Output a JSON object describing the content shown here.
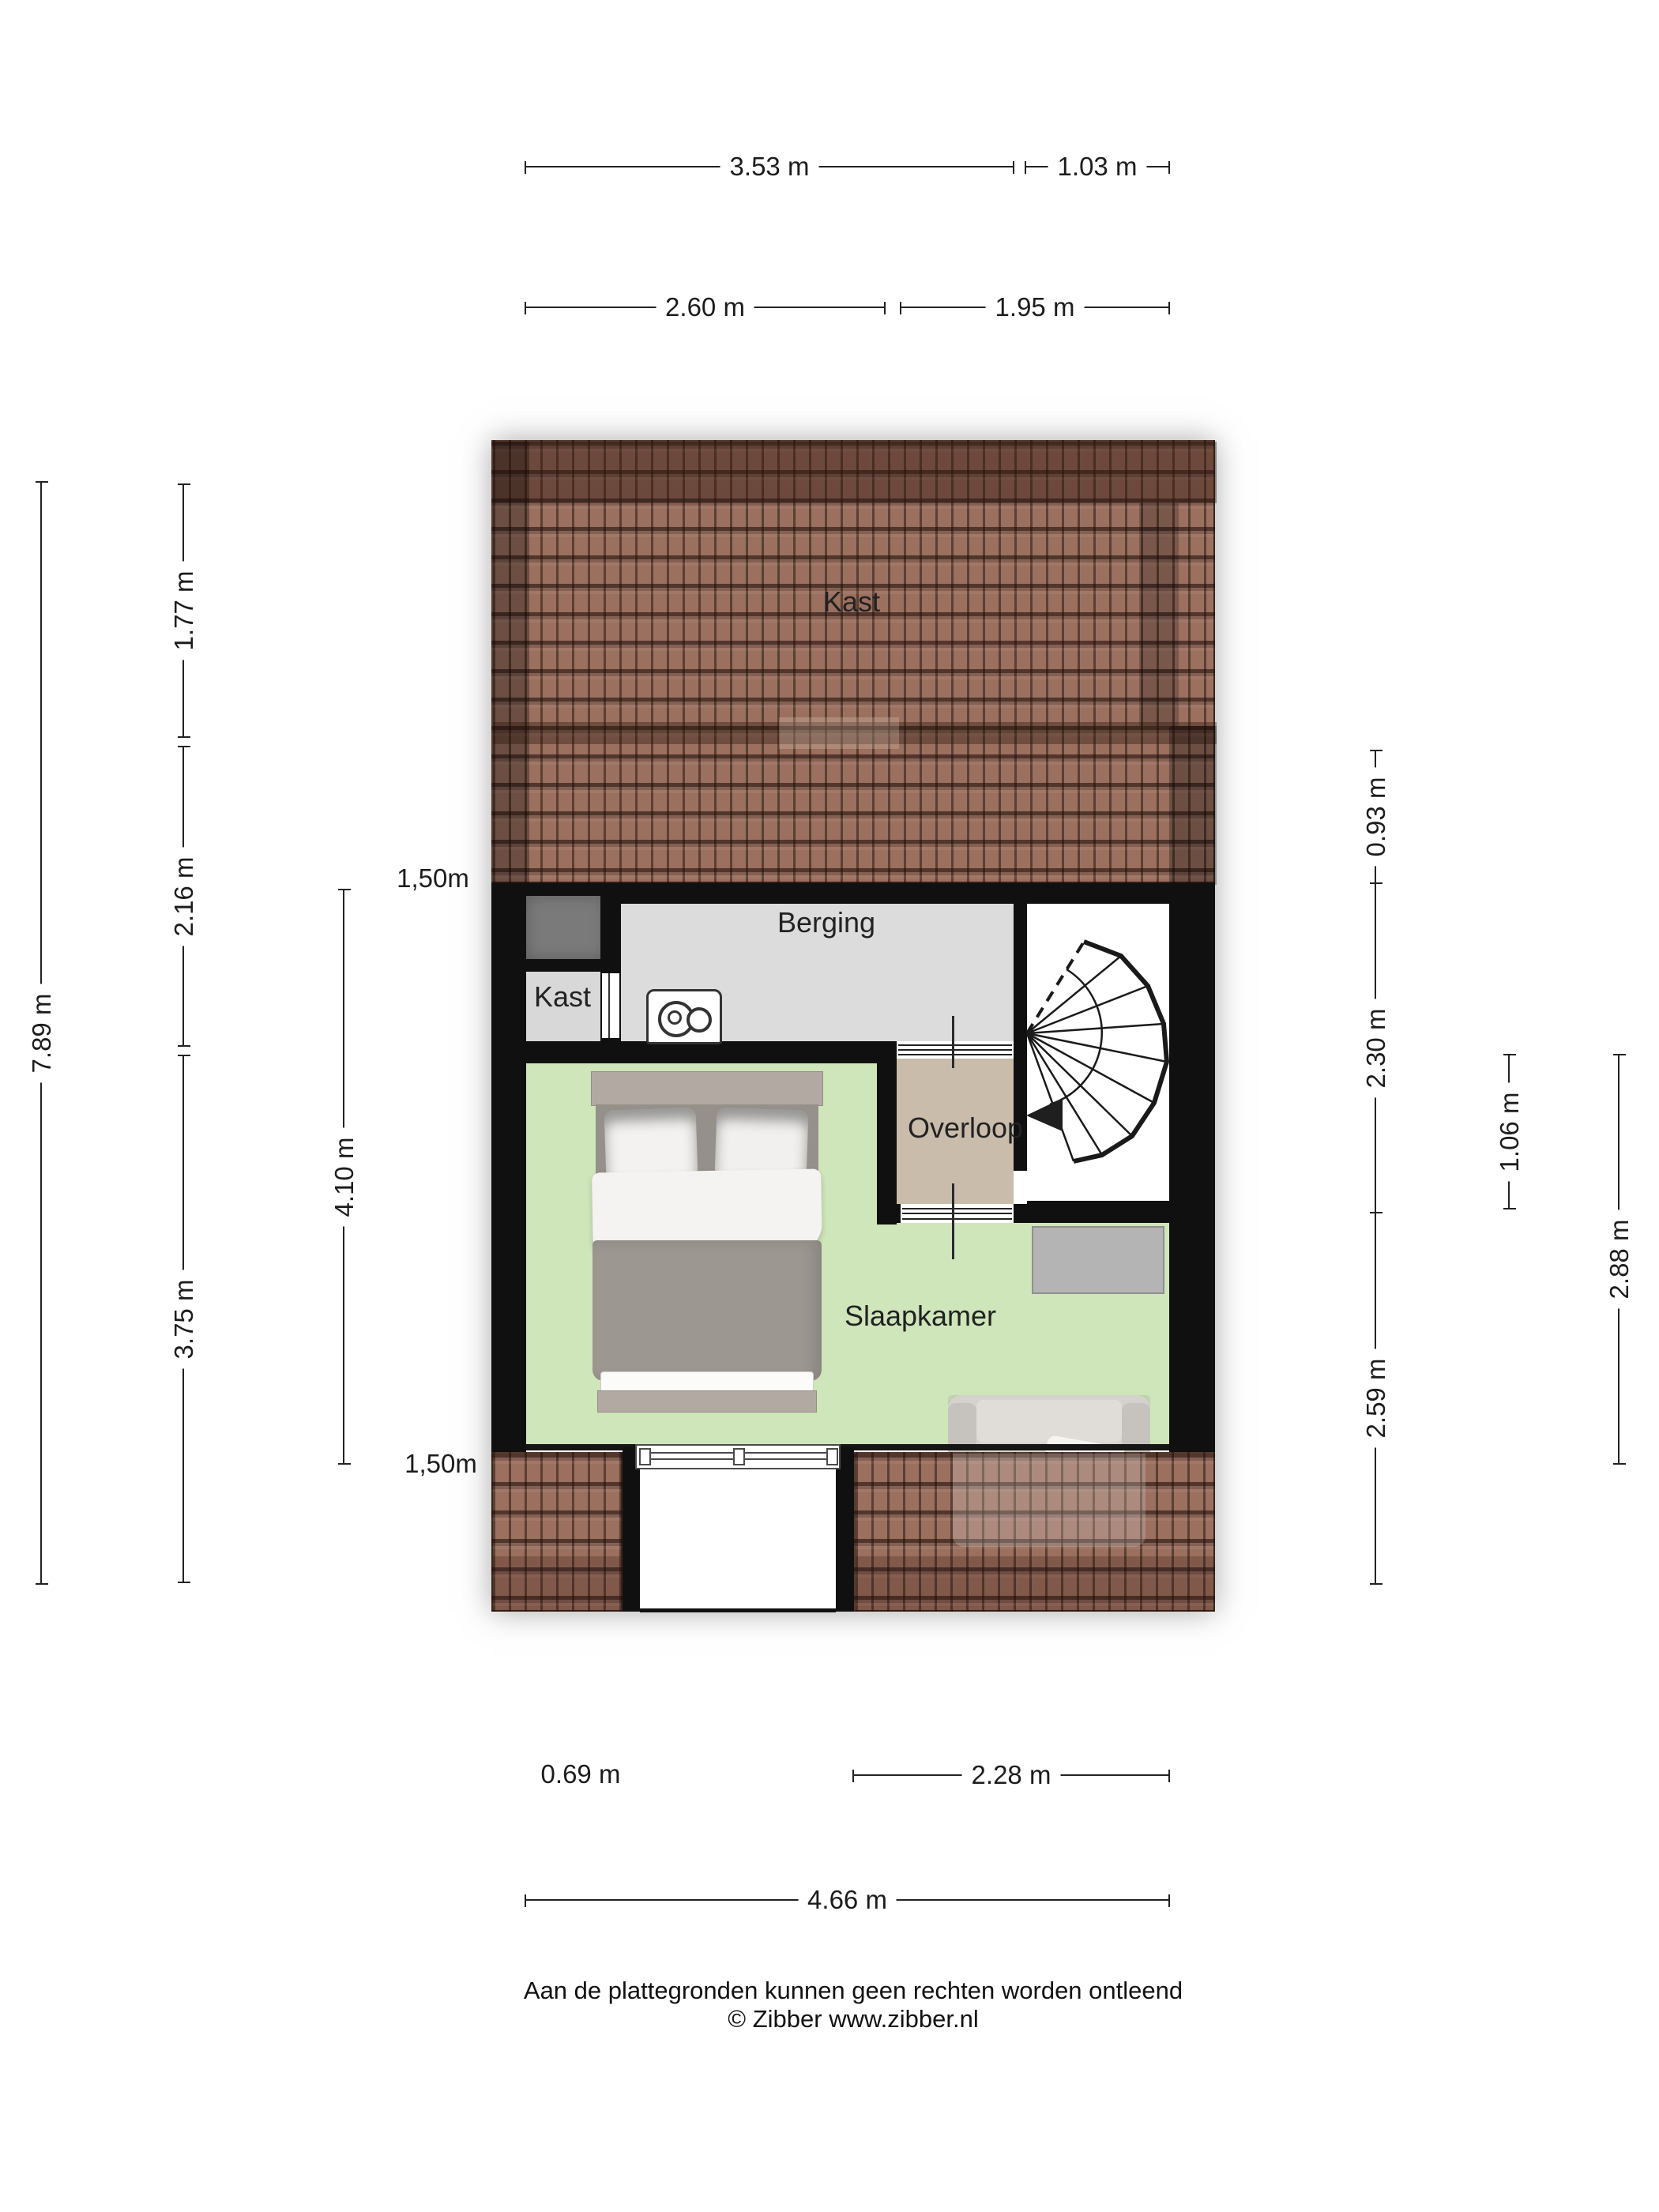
{
  "title": "Floor plan - attic storey (Zibber plattegrond)",
  "rooms": {
    "attic_closet": "Kast",
    "storage": "Berging",
    "closet": "Kast",
    "landing": "Overloop",
    "bedroom": "Slaapkamer"
  },
  "dimensions": {
    "top": [
      {
        "label": "3.53 m"
      },
      {
        "label": "1.03 m"
      },
      {
        "label": "2.60 m"
      },
      {
        "label": "1.95 m"
      }
    ],
    "left": [
      {
        "label": "7.89 m"
      },
      {
        "label": "1.77 m"
      },
      {
        "label": "2.16 m"
      },
      {
        "label": "3.75 m"
      },
      {
        "label": "4.10 m"
      }
    ],
    "left_headroom": [
      {
        "label": "1,50m"
      },
      {
        "label": "1,50m"
      }
    ],
    "right": [
      {
        "label": "0.93 m"
      },
      {
        "label": "2.30 m"
      },
      {
        "label": "2.59 m"
      },
      {
        "label": "1.06 m"
      },
      {
        "label": "2.88 m"
      }
    ],
    "bottom": [
      {
        "label": "0.69 m"
      },
      {
        "label": "2.28 m"
      },
      {
        "label": "4.66 m"
      }
    ]
  },
  "footer": {
    "line1": "Aan de plattegronden kunnen geen rechten worden ontleend",
    "line2": "© Zibber www.zibber.nl"
  },
  "colors": {
    "wall": "#101010",
    "roof_base": "#9b705f",
    "floor_gray": "#dcdcdc",
    "floor_green": "#cfe5ba",
    "floor_tan": "#c9bcab",
    "shaft": "#7a7a7a",
    "furniture": "#b4b4b4",
    "bed_duvet": "#9d9791",
    "bed_frame": "#b2aaa2",
    "dim_line": "#222222"
  }
}
